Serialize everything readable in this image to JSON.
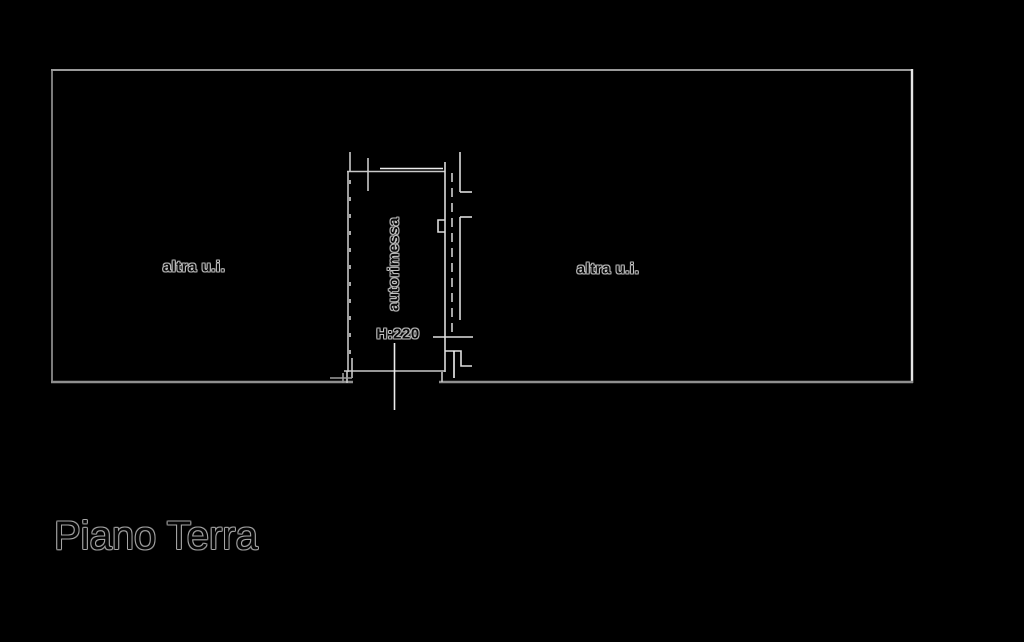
{
  "page": {
    "background_color": "#000000",
    "line_color": "#9a9a9a",
    "bright_line_color": "#ededed",
    "text_halo_color": "#c4c4c4"
  },
  "floorplan": {
    "title": "Piano Terra",
    "left_unit_label": "altra u.i.",
    "right_unit_label": "altra u.i.",
    "garage": {
      "label": "autorimessa",
      "height_note": "H:220"
    }
  }
}
